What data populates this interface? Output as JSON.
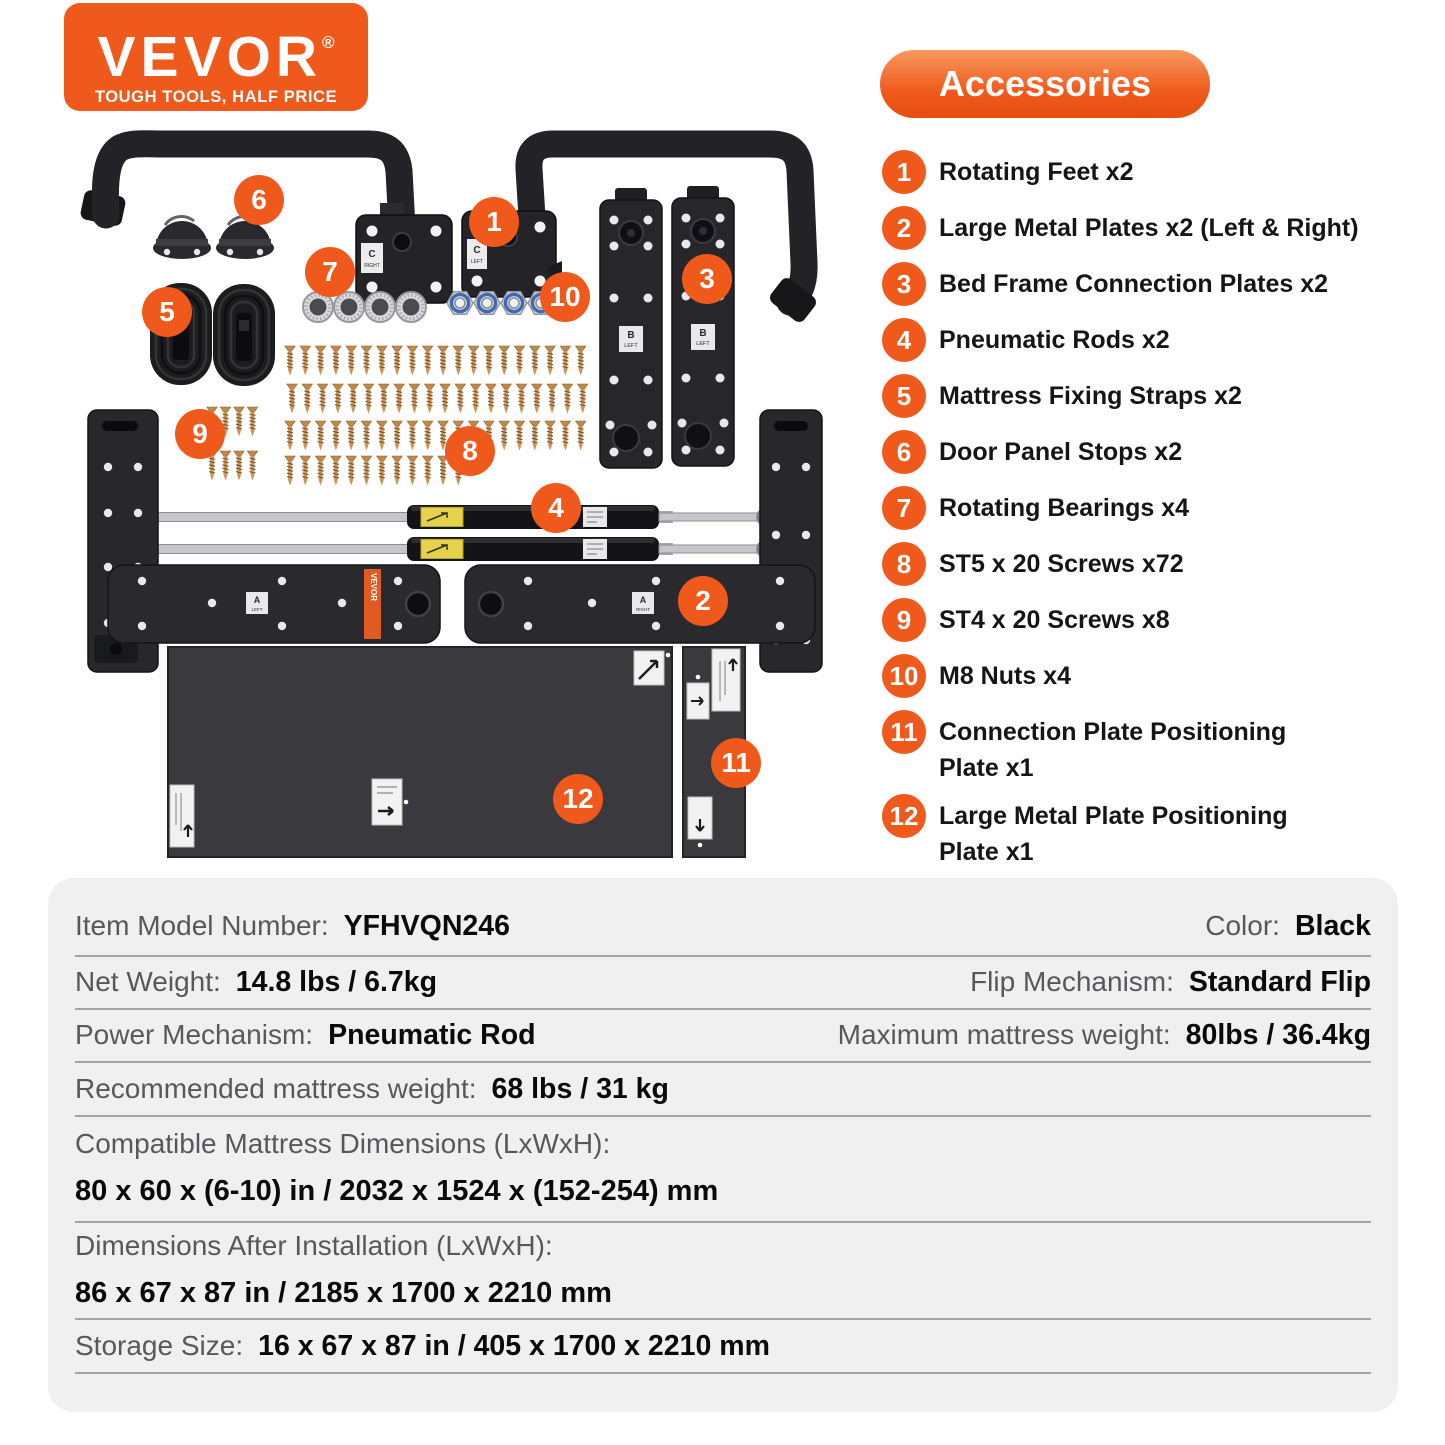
{
  "colors": {
    "accent": "#F0591C",
    "accent_gradient_top": "#F79A5E",
    "table_background": "#F0F0F1",
    "hardware_black": "#232327",
    "panel_gray": "#3A3A3E",
    "screw_gold": "#C18A4D",
    "label_gray": "#57585A"
  },
  "logo": {
    "brand": "VEVOR",
    "registered": "®",
    "tagline": "TOUGH TOOLS, HALF PRICE"
  },
  "accessories": {
    "title": "Accessories",
    "items": [
      {
        "num": "1",
        "label": "Rotating Feet x2"
      },
      {
        "num": "2",
        "label": "Large Metal Plates x2 (Left & Right)"
      },
      {
        "num": "3",
        "label": "Bed Frame Connection Plates x2"
      },
      {
        "num": "4",
        "label": "Pneumatic Rods x2"
      },
      {
        "num": "5",
        "label": "Mattress Fixing Straps x2"
      },
      {
        "num": "6",
        "label": "Door Panel Stops x2"
      },
      {
        "num": "7",
        "label": "Rotating Bearings x4"
      },
      {
        "num": "8",
        "label": "ST5 x 20 Screws x72"
      },
      {
        "num": "9",
        "label": "ST4 x 20 Screws x8"
      },
      {
        "num": "10",
        "label": "M8 Nuts x4"
      },
      {
        "num": "11",
        "label": "Connection Plate Positioning\nPlate x1"
      },
      {
        "num": "12",
        "label": "Large Metal Plate Positioning\nPlate x1"
      }
    ]
  },
  "collage": {
    "part_labels": {
      "c": "C",
      "right": "RIGHT",
      "left": "LEFT",
      "b": "B",
      "a": "A",
      "vevor": "VEVOR"
    }
  },
  "specs": {
    "rows": [
      {
        "cells": [
          {
            "label": "Item Model Number:",
            "value": "YFHVQN246"
          },
          {
            "label": "Color:",
            "value": "Black"
          }
        ]
      },
      {
        "cells": [
          {
            "label": "Net Weight:",
            "value": "14.8 lbs / 6.7kg"
          },
          {
            "label": "Flip Mechanism:",
            "value": "Standard Flip"
          }
        ]
      },
      {
        "cells": [
          {
            "label": "Power Mechanism:",
            "value": "Pneumatic Rod"
          },
          {
            "label": "Maximum mattress weight:",
            "value": "80lbs / 36.4kg"
          }
        ]
      },
      {
        "cells": [
          {
            "label": "Recommended mattress weight:",
            "value": "68 lbs / 31 kg"
          }
        ]
      },
      {
        "label": "Compatible Mattress Dimensions (LxWxH):",
        "value": "80 x 60 x (6-10) in / 2032 x 1524 x (152-254) mm"
      },
      {
        "label": "Dimensions After Installation (LxWxH):",
        "value": "86 x 67 x 87 in / 2185 x 1700 x 2210 mm"
      },
      {
        "cells": [
          {
            "label": "Storage Size:",
            "value": "16 x 67 x 87 in / 405 x 1700 x 2210 mm"
          }
        ]
      }
    ]
  }
}
